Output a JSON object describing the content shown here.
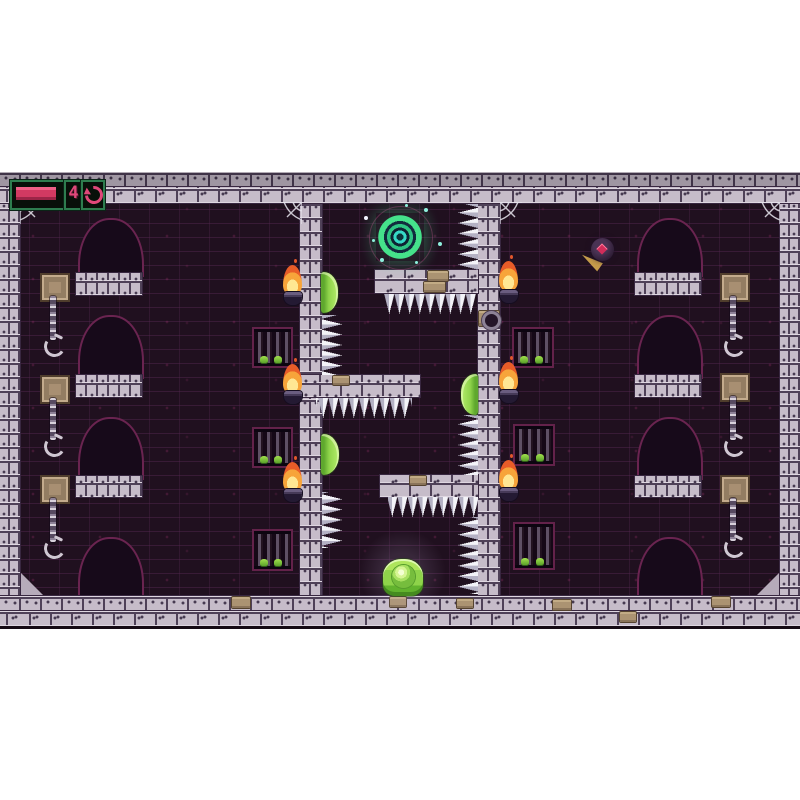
{
  "hud": {
    "health_bar": {
      "name": "health",
      "fill_ratio": 1.0,
      "fill_color": "#d23a62",
      "border_color": "#2e7d4f"
    },
    "counter": {
      "value": "4",
      "color": "#e0487a"
    },
    "restart": {
      "icon": "restart-arrow-icon",
      "color": "#e0487a"
    }
  },
  "level": {
    "theme": "purple-stone-dungeon",
    "background_color": "#20101f",
    "stone_color": "#c6bcc9",
    "outline_accent_color": "#6a2450",
    "entities": {
      "portal": {
        "type": "ring-portal",
        "colors": [
          "#45e28b",
          "#36d9c7"
        ],
        "location": "top-of-middle-chamber"
      },
      "player": {
        "type": "green-slime",
        "color": "#8ed34a",
        "location": "bottom-of-middle-chamber"
      },
      "wall_slimes": {
        "count": 3,
        "color": "#8ed34a"
      },
      "comet": {
        "type": "orb-with-flame-tail",
        "body_color": "#2c1c33",
        "eye_color": "#d12d5a",
        "tail_color": "#cfa44e",
        "location": "upper-right-chamber"
      },
      "torches": {
        "count": 6,
        "flame_color": "#f7a43a"
      },
      "cages": {
        "count": 6,
        "creatures_per_cage": 2,
        "creature_color": "#7ed13e"
      },
      "hanging_chains": {
        "count": 6
      },
      "wall_plaques": {
        "count": 6
      },
      "arches": {
        "count": 8
      },
      "platforms": {
        "count": 3
      },
      "spike_strips": {
        "count": 8,
        "color": "#f3f3f8"
      },
      "spiderwebs": {
        "count": 4
      }
    }
  }
}
